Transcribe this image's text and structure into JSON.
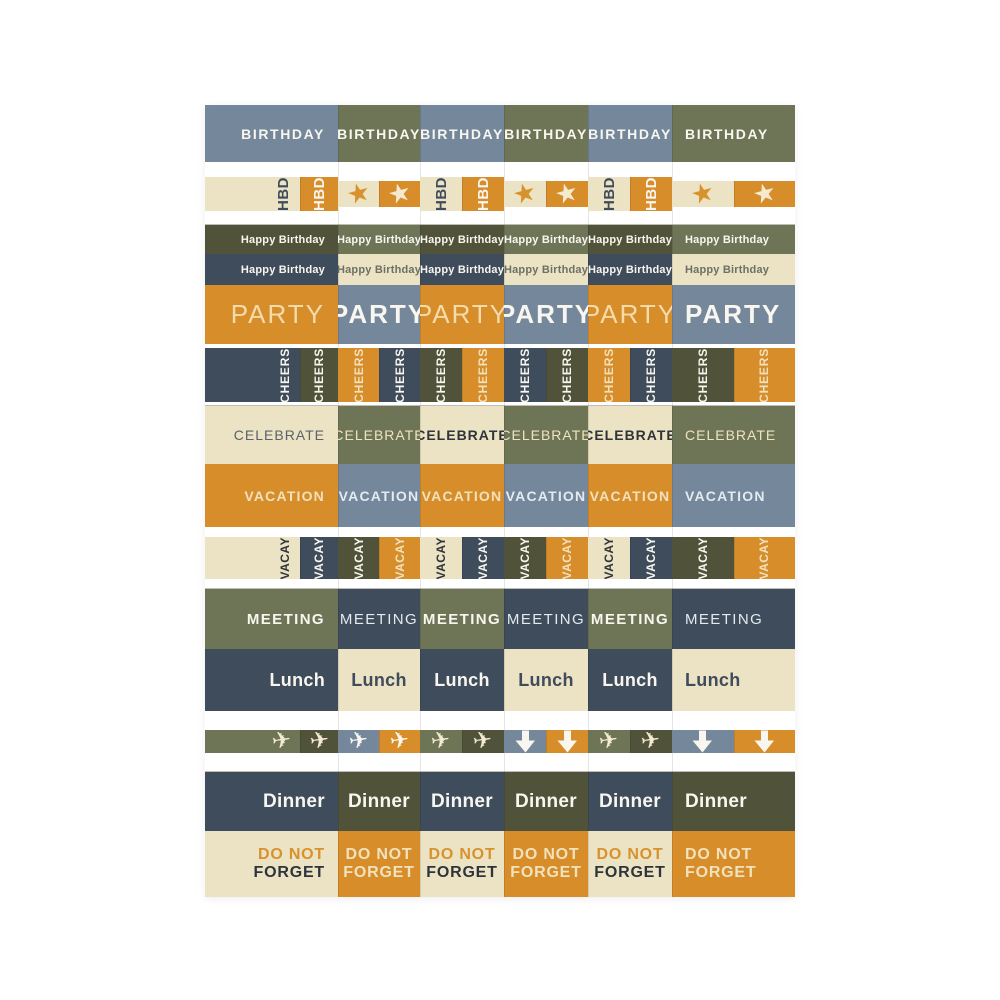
{
  "palette": {
    "slate": "#75879b",
    "olive": "#6e7557",
    "darkOlive": "#50533a",
    "darkSlate": "#3f4c5b",
    "cream": "#ece2c4",
    "orange": "#d88d2b",
    "white": "#f8f6ef",
    "ivory": "#f3ead0",
    "creamText": "#f0e2bc",
    "paleBlue": "#e3eaf0",
    "lightOrange": "#f3dcab",
    "charcoal": "#2e343a",
    "slateText": "#3f4c5b",
    "graySlate": "#5a626c",
    "oliveGray": "#6b7164",
    "orangeText": "#d8922d"
  },
  "rows": [
    {
      "id": "birthday",
      "height": 57,
      "kind": "label",
      "fontSize": 14,
      "weight": 600,
      "ls": 1.6,
      "cells": [
        {
          "label": "BIRTHDAY",
          "bg": "slate",
          "fg": "white"
        },
        {
          "label": "BIRTHDAY",
          "bg": "olive",
          "fg": "white"
        },
        {
          "label": "BIRTHDAY",
          "bg": "slate",
          "fg": "white"
        },
        {
          "label": "BIRTHDAY",
          "bg": "olive",
          "fg": "white"
        },
        {
          "label": "BIRTHDAY",
          "bg": "slate",
          "fg": "white"
        },
        {
          "label": "BIRTHDAY",
          "bg": "olive",
          "fg": "white"
        }
      ]
    },
    {
      "id": "hbd-stars",
      "height": 63,
      "kind": "pair",
      "fontSize": 15,
      "weight": 700,
      "ls": 0.5,
      "cells": [
        {
          "a": {
            "label": "HBD",
            "bg": "cream",
            "fg": "slateText"
          },
          "b": {
            "label": "HBD",
            "bg": "orange",
            "fg": "white"
          }
        },
        {
          "a": {
            "icon": "star",
            "bg": "cream",
            "fg": "orangeText"
          },
          "b": {
            "icon": "star",
            "bg": "orange",
            "fg": "ivory"
          }
        },
        {
          "a": {
            "label": "HBD",
            "bg": "cream",
            "fg": "slateText"
          },
          "b": {
            "label": "HBD",
            "bg": "orange",
            "fg": "white"
          }
        },
        {
          "a": {
            "icon": "star",
            "bg": "cream",
            "fg": "orangeText"
          },
          "b": {
            "icon": "star",
            "bg": "orange",
            "fg": "ivory"
          }
        },
        {
          "a": {
            "label": "HBD",
            "bg": "cream",
            "fg": "slateText"
          },
          "b": {
            "label": "HBD",
            "bg": "orange",
            "fg": "white"
          }
        },
        {
          "a": {
            "icon": "star",
            "bg": "cream",
            "fg": "orangeText"
          },
          "b": {
            "icon": "star",
            "bg": "orange",
            "fg": "ivory"
          }
        }
      ]
    },
    {
      "id": "happy-birthday-olive",
      "height": 29,
      "kind": "label",
      "fontSize": 11,
      "weight": 700,
      "ls": 0.2,
      "cells": [
        {
          "label": "Happy Birthday",
          "bg": "darkOlive",
          "fg": "white"
        },
        {
          "label": "Happy Birthday",
          "bg": "olive",
          "fg": "white"
        },
        {
          "label": "Happy Birthday",
          "bg": "darkOlive",
          "fg": "white"
        },
        {
          "label": "Happy Birthday",
          "bg": "olive",
          "fg": "white"
        },
        {
          "label": "Happy Birthday",
          "bg": "darkOlive",
          "fg": "white"
        },
        {
          "label": "Happy Birthday",
          "bg": "olive",
          "fg": "white"
        }
      ]
    },
    {
      "id": "happy-birthday-slate",
      "height": 31,
      "kind": "label",
      "fontSize": 11,
      "weight": 700,
      "ls": 0.2,
      "cells": [
        {
          "label": "Happy Birthday",
          "bg": "darkSlate",
          "fg": "white"
        },
        {
          "label": "Happy Birthday",
          "bg": "cream",
          "fg": "oliveGray"
        },
        {
          "label": "Happy Birthday",
          "bg": "darkSlate",
          "fg": "white"
        },
        {
          "label": "Happy Birthday",
          "bg": "cream",
          "fg": "oliveGray"
        },
        {
          "label": "Happy Birthday",
          "bg": "darkSlate",
          "fg": "white"
        },
        {
          "label": "Happy Birthday",
          "bg": "cream",
          "fg": "oliveGray"
        }
      ]
    },
    {
      "id": "party",
      "height": 59,
      "kind": "label",
      "fontSize": 26,
      "ls": 2,
      "cells": [
        {
          "label": "PARTY",
          "bg": "orange",
          "fg": "lightOrange",
          "weight": 300
        },
        {
          "label": "PARTY",
          "bg": "slate",
          "fg": "white",
          "weight": 700
        },
        {
          "label": "PARTY",
          "bg": "orange",
          "fg": "lightOrange",
          "weight": 300
        },
        {
          "label": "PARTY",
          "bg": "slate",
          "fg": "white",
          "weight": 700
        },
        {
          "label": "PARTY",
          "bg": "orange",
          "fg": "lightOrange",
          "weight": 300
        },
        {
          "label": "PARTY",
          "bg": "slate",
          "fg": "white",
          "weight": 700
        }
      ]
    },
    {
      "id": "cheers",
      "height": 62,
      "kind": "pair",
      "fontSize": 12,
      "weight": 700,
      "ls": 0.8,
      "cells": [
        {
          "a": {
            "label": "CHEERS",
            "bg": "darkSlate",
            "fg": "white"
          },
          "b": {
            "label": "CHEERS",
            "bg": "darkOlive",
            "fg": "white"
          }
        },
        {
          "a": {
            "label": "CHEERS",
            "bg": "orange",
            "fg": "creamText"
          },
          "b": {
            "label": "CHEERS",
            "bg": "darkSlate",
            "fg": "white"
          }
        },
        {
          "a": {
            "label": "CHEERS",
            "bg": "darkOlive",
            "fg": "white"
          },
          "b": {
            "label": "CHEERS",
            "bg": "orange",
            "fg": "creamText"
          }
        },
        {
          "a": {
            "label": "CHEERS",
            "bg": "darkSlate",
            "fg": "white"
          },
          "b": {
            "label": "CHEERS",
            "bg": "darkOlive",
            "fg": "white"
          }
        },
        {
          "a": {
            "label": "CHEERS",
            "bg": "orange",
            "fg": "creamText"
          },
          "b": {
            "label": "CHEERS",
            "bg": "darkSlate",
            "fg": "white"
          }
        },
        {
          "a": {
            "label": "CHEERS",
            "bg": "darkOlive",
            "fg": "white"
          },
          "b": {
            "label": "CHEERS",
            "bg": "orange",
            "fg": "creamText"
          }
        }
      ]
    },
    {
      "id": "celebrate",
      "height": 58,
      "kind": "label",
      "fontSize": 14,
      "ls": 1,
      "cells": [
        {
          "label": "CELEBRATE",
          "bg": "cream",
          "fg": "graySlate",
          "weight": 400
        },
        {
          "label": "CELEBRATE",
          "bg": "olive",
          "fg": "creamText",
          "weight": 400
        },
        {
          "label": "CELEBRATE",
          "bg": "cream",
          "fg": "charcoal",
          "weight": 700
        },
        {
          "label": "CELEBRATE",
          "bg": "olive",
          "fg": "creamText",
          "weight": 400
        },
        {
          "label": "CELEBRATE",
          "bg": "cream",
          "fg": "charcoal",
          "weight": 700
        },
        {
          "label": "CELEBRATE",
          "bg": "olive",
          "fg": "creamText",
          "weight": 400
        }
      ]
    },
    {
      "id": "vacation",
      "height": 63,
      "kind": "label",
      "fontSize": 14,
      "weight": 600,
      "ls": 1.2,
      "cells": [
        {
          "label": "VACATION",
          "bg": "orange",
          "fg": "creamText"
        },
        {
          "label": "VACATION",
          "bg": "slate",
          "fg": "paleBlue"
        },
        {
          "label": "VACATION",
          "bg": "orange",
          "fg": "creamText"
        },
        {
          "label": "VACATION",
          "bg": "slate",
          "fg": "paleBlue"
        },
        {
          "label": "VACATION",
          "bg": "orange",
          "fg": "creamText"
        },
        {
          "label": "VACATION",
          "bg": "slate",
          "fg": "paleBlue"
        }
      ]
    },
    {
      "id": "vacay",
      "height": 62,
      "kind": "pair",
      "fontSize": 12,
      "weight": 700,
      "ls": 0.5,
      "cells": [
        {
          "a": {
            "label": "VACAY",
            "bg": "cream",
            "fg": "charcoal"
          },
          "b": {
            "label": "VACAY",
            "bg": "darkSlate",
            "fg": "white"
          }
        },
        {
          "a": {
            "label": "VACAY",
            "bg": "darkOlive",
            "fg": "white"
          },
          "b": {
            "label": "VACAY",
            "bg": "orange",
            "fg": "creamText"
          }
        },
        {
          "a": {
            "label": "VACAY",
            "bg": "cream",
            "fg": "charcoal"
          },
          "b": {
            "label": "VACAY",
            "bg": "darkSlate",
            "fg": "white"
          }
        },
        {
          "a": {
            "label": "VACAY",
            "bg": "darkOlive",
            "fg": "white"
          },
          "b": {
            "label": "VACAY",
            "bg": "orange",
            "fg": "creamText"
          }
        },
        {
          "a": {
            "label": "VACAY",
            "bg": "cream",
            "fg": "charcoal"
          },
          "b": {
            "label": "VACAY",
            "bg": "darkSlate",
            "fg": "white"
          }
        },
        {
          "a": {
            "label": "VACAY",
            "bg": "darkOlive",
            "fg": "white"
          },
          "b": {
            "label": "VACAY",
            "bg": "orange",
            "fg": "creamText"
          }
        }
      ]
    },
    {
      "id": "meeting",
      "height": 60,
      "kind": "label",
      "fontSize": 15,
      "ls": 1.4,
      "cells": [
        {
          "label": "MEETING",
          "bg": "olive",
          "fg": "white",
          "weight": 700
        },
        {
          "label": "MEETING",
          "bg": "darkSlate",
          "fg": "paleBlue",
          "weight": 300
        },
        {
          "label": "MEETING",
          "bg": "olive",
          "fg": "white",
          "weight": 700
        },
        {
          "label": "MEETING",
          "bg": "darkSlate",
          "fg": "paleBlue",
          "weight": 300
        },
        {
          "label": "MEETING",
          "bg": "olive",
          "fg": "white",
          "weight": 700
        },
        {
          "label": "MEETING",
          "bg": "darkSlate",
          "fg": "paleBlue",
          "weight": 300
        }
      ]
    },
    {
      "id": "lunch",
      "height": 62,
      "kind": "label",
      "fontSize": 18,
      "weight": 700,
      "ls": 0.3,
      "cells": [
        {
          "label": "Lunch",
          "bg": "darkSlate",
          "fg": "white"
        },
        {
          "label": "Lunch",
          "bg": "cream",
          "fg": "slateText"
        },
        {
          "label": "Lunch",
          "bg": "darkSlate",
          "fg": "white"
        },
        {
          "label": "Lunch",
          "bg": "cream",
          "fg": "slateText"
        },
        {
          "label": "Lunch",
          "bg": "darkSlate",
          "fg": "white"
        },
        {
          "label": "Lunch",
          "bg": "cream",
          "fg": "slateText"
        }
      ]
    },
    {
      "id": "travel-icons",
      "height": 61,
      "kind": "pair",
      "fontSize": 12,
      "weight": 700,
      "ls": 0,
      "cells": [
        {
          "a": {
            "icon": "airplane",
            "bg": "olive",
            "fg": "ivory"
          },
          "b": {
            "icon": "airplane",
            "bg": "darkOlive",
            "fg": "ivory"
          }
        },
        {
          "a": {
            "icon": "airplane",
            "bg": "slate",
            "fg": "white"
          },
          "b": {
            "icon": "airplane",
            "bg": "orange",
            "fg": "white"
          }
        },
        {
          "a": {
            "icon": "airplane",
            "bg": "olive",
            "fg": "ivory"
          },
          "b": {
            "icon": "airplane",
            "bg": "darkOlive",
            "fg": "ivory"
          }
        },
        {
          "a": {
            "icon": "arrow-down",
            "bg": "slate",
            "fg": "white"
          },
          "b": {
            "icon": "arrow-down",
            "bg": "orange",
            "fg": "white"
          }
        },
        {
          "a": {
            "icon": "airplane",
            "bg": "olive",
            "fg": "ivory"
          },
          "b": {
            "icon": "airplane",
            "bg": "darkOlive",
            "fg": "ivory"
          }
        },
        {
          "a": {
            "icon": "arrow-down",
            "bg": "slate",
            "fg": "white"
          },
          "b": {
            "icon": "arrow-down",
            "bg": "orange",
            "fg": "white"
          }
        }
      ]
    },
    {
      "id": "dinner",
      "height": 59,
      "kind": "label",
      "fontSize": 19,
      "weight": 700,
      "ls": 0.3,
      "cells": [
        {
          "label": "Dinner",
          "bg": "darkSlate",
          "fg": "white"
        },
        {
          "label": "Dinner",
          "bg": "darkOlive",
          "fg": "white"
        },
        {
          "label": "Dinner",
          "bg": "darkSlate",
          "fg": "white"
        },
        {
          "label": "Dinner",
          "bg": "darkOlive",
          "fg": "white"
        },
        {
          "label": "Dinner",
          "bg": "darkSlate",
          "fg": "white"
        },
        {
          "label": "Dinner",
          "bg": "darkOlive",
          "fg": "white"
        }
      ]
    },
    {
      "id": "do-not-forget",
      "height": 66,
      "kind": "two-line",
      "fontSize": 16,
      "cells": [
        {
          "line1": "DO NOT",
          "line2": "FORGET",
          "bg": "cream",
          "fg1": "orangeText",
          "fg2": "charcoal"
        },
        {
          "line1": "DO NOT",
          "line2": "FORGET",
          "bg": "orange",
          "fg1": "creamText",
          "fg2": "creamText"
        },
        {
          "line1": "DO NOT",
          "line2": "FORGET",
          "bg": "cream",
          "fg1": "orangeText",
          "fg2": "charcoal"
        },
        {
          "line1": "DO NOT",
          "line2": "FORGET",
          "bg": "orange",
          "fg1": "creamText",
          "fg2": "creamText"
        },
        {
          "line1": "DO NOT",
          "line2": "FORGET",
          "bg": "cream",
          "fg1": "orangeText",
          "fg2": "charcoal"
        },
        {
          "line1": "DO NOT",
          "line2": "FORGET",
          "bg": "orange",
          "fg1": "creamText",
          "fg2": "creamText"
        }
      ]
    }
  ]
}
